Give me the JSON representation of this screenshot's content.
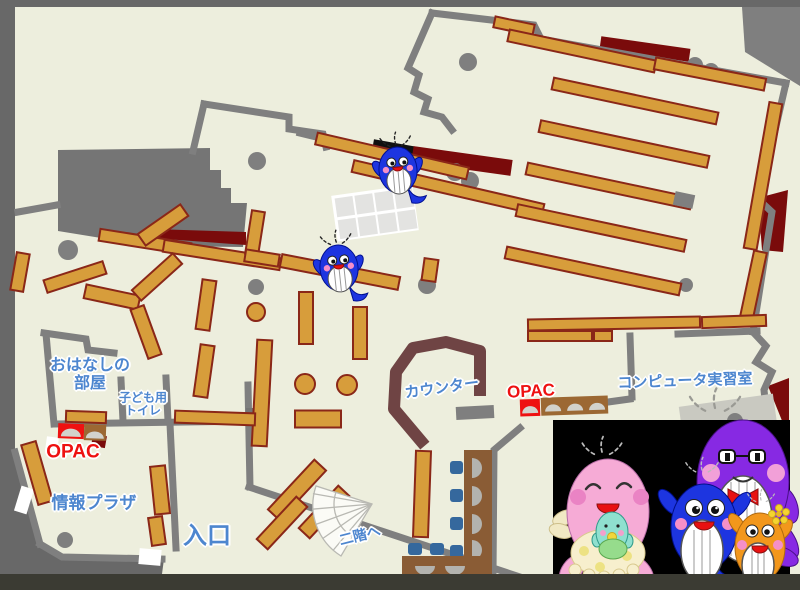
{
  "labels": {
    "storytelling_room_line1": "おはなしの",
    "storytelling_room_line2": "部屋",
    "kids_toilet_line1": "子ども用",
    "kids_toilet_line2": "トイレ",
    "opac_left": "OPAC",
    "opac_right": "OPAC",
    "info_plaza": "情報プラザ",
    "entrance": "入口",
    "counter": "カウンター",
    "computer_room": "コンピュータ実習室",
    "stairs_up": "二階へ"
  },
  "mascots": {
    "family": [
      "pink-whale-mascot",
      "blue-whale-mascot",
      "purple-whale-mascot",
      "orange-whale-mascot"
    ],
    "map_whale_count": 2
  },
  "colors": {
    "frame": "#686868",
    "frame_bottom": "#3b3b33",
    "floor": "#edeedd",
    "wall": "#7f7f7f",
    "block": "#757575",
    "shelf": "#d79d3b",
    "shelf_border": "#8a2718",
    "dark_red": "#7a0b0b",
    "counter": "#6f4444",
    "opac_red": "#ee1111",
    "station_brown": "#9c6833",
    "arch": "#d2d2cc",
    "label_blue": "#4d86cf",
    "label_outline": "#ffffff",
    "desk_brown": "#8a5c35",
    "chair_blue": "#35689d",
    "seat": "#b3b3af",
    "grid_cell": "#e3e3e1",
    "stair_line": "#b9b9b3",
    "panel": "#000000",
    "whale_blue": "#1d35e0",
    "mascot_pink": "#f6abd6",
    "mascot_purple": "#8729e3",
    "mascot_orange": "#f2971c",
    "mascot_teal": "#8fe0cf",
    "belly": "#ffffff"
  }
}
